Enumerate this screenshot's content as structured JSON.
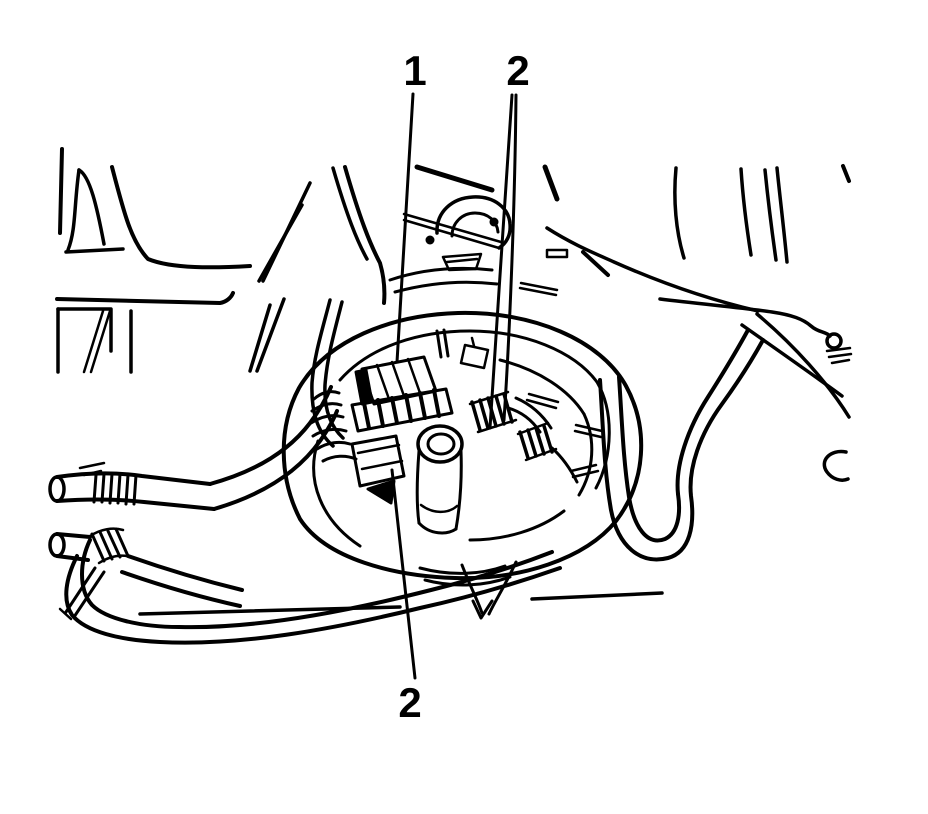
{
  "figure": {
    "kind": "black-and-white line-art service illustration",
    "background_color": "#ffffff",
    "line_color": "#000000",
    "callouts": [
      {
        "label": "1",
        "x": 415,
        "y": 85,
        "points_to_x": 397,
        "points_to_y": 362
      },
      {
        "label": "2",
        "x": 518,
        "y": 85,
        "points_to_x": 494,
        "points_to_y": 424
      },
      {
        "label": "2",
        "x": 410,
        "y": 717,
        "points_to_x": 392,
        "points_to_y": 470
      }
    ]
  }
}
